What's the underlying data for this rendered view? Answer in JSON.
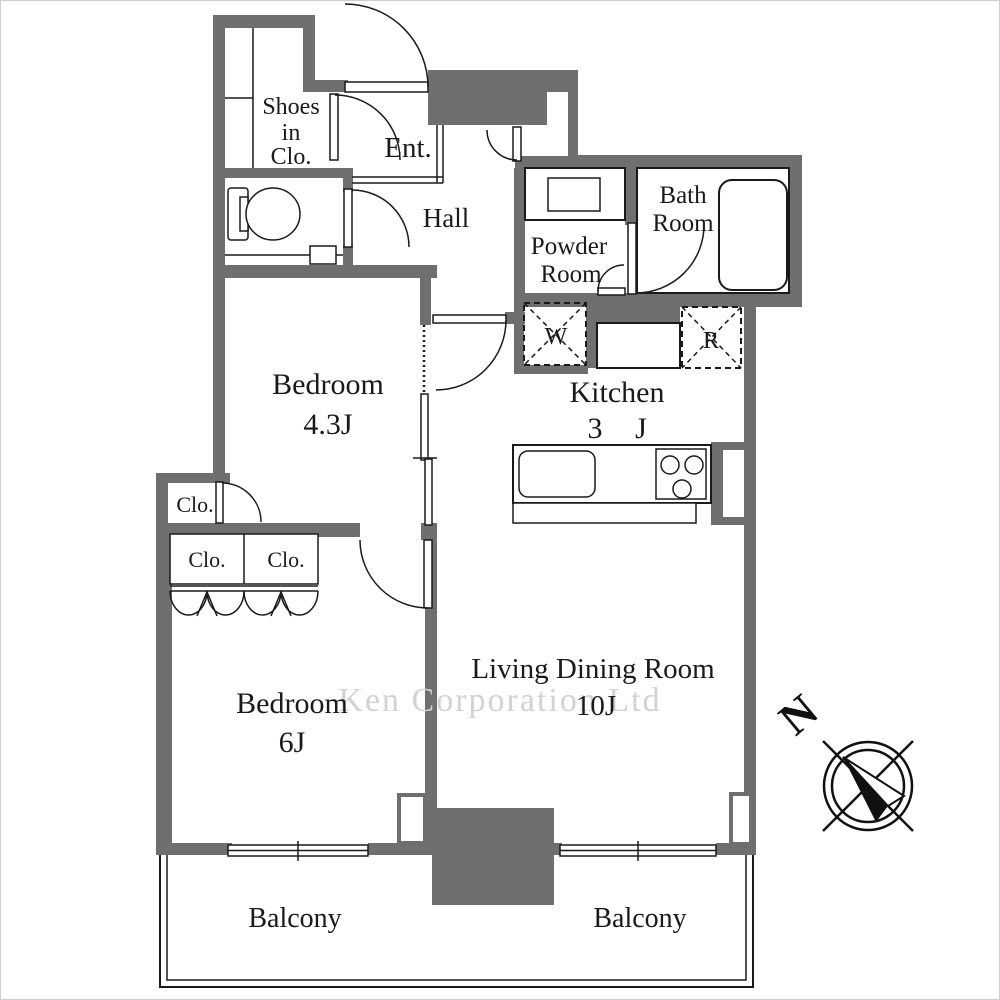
{
  "rooms": {
    "shoes_closet": {
      "line1": "Shoes",
      "line2": "in",
      "line3": "Clo."
    },
    "entrance": "Ent.",
    "hall": "Hall",
    "powder_room": {
      "line1": "Powder",
      "line2": "Room"
    },
    "bath_room": {
      "line1": "Bath",
      "line2": "Room"
    },
    "washer": "W",
    "refrigerator": "R",
    "kitchen": {
      "name": "Kitchen",
      "size_left": "3",
      "size_right": "J"
    },
    "bedroom_43": {
      "name": "Bedroom",
      "size": "4.3J"
    },
    "closet_small": "Clo.",
    "closet_left": "Clo.",
    "closet_right": "Clo.",
    "bedroom_6": {
      "name": "Bedroom",
      "size": "6J"
    },
    "living_dining": {
      "name": "Living Dining Room",
      "size": "10J"
    },
    "balcony_left": "Balcony",
    "balcony_right": "Balcony"
  },
  "compass": {
    "north_label": "N"
  },
  "watermark": "Ken Corporation Ltd",
  "colors": {
    "wall": "#6f6f6f",
    "line": "#1a1a1a",
    "watermark": "#d2d2d2"
  }
}
